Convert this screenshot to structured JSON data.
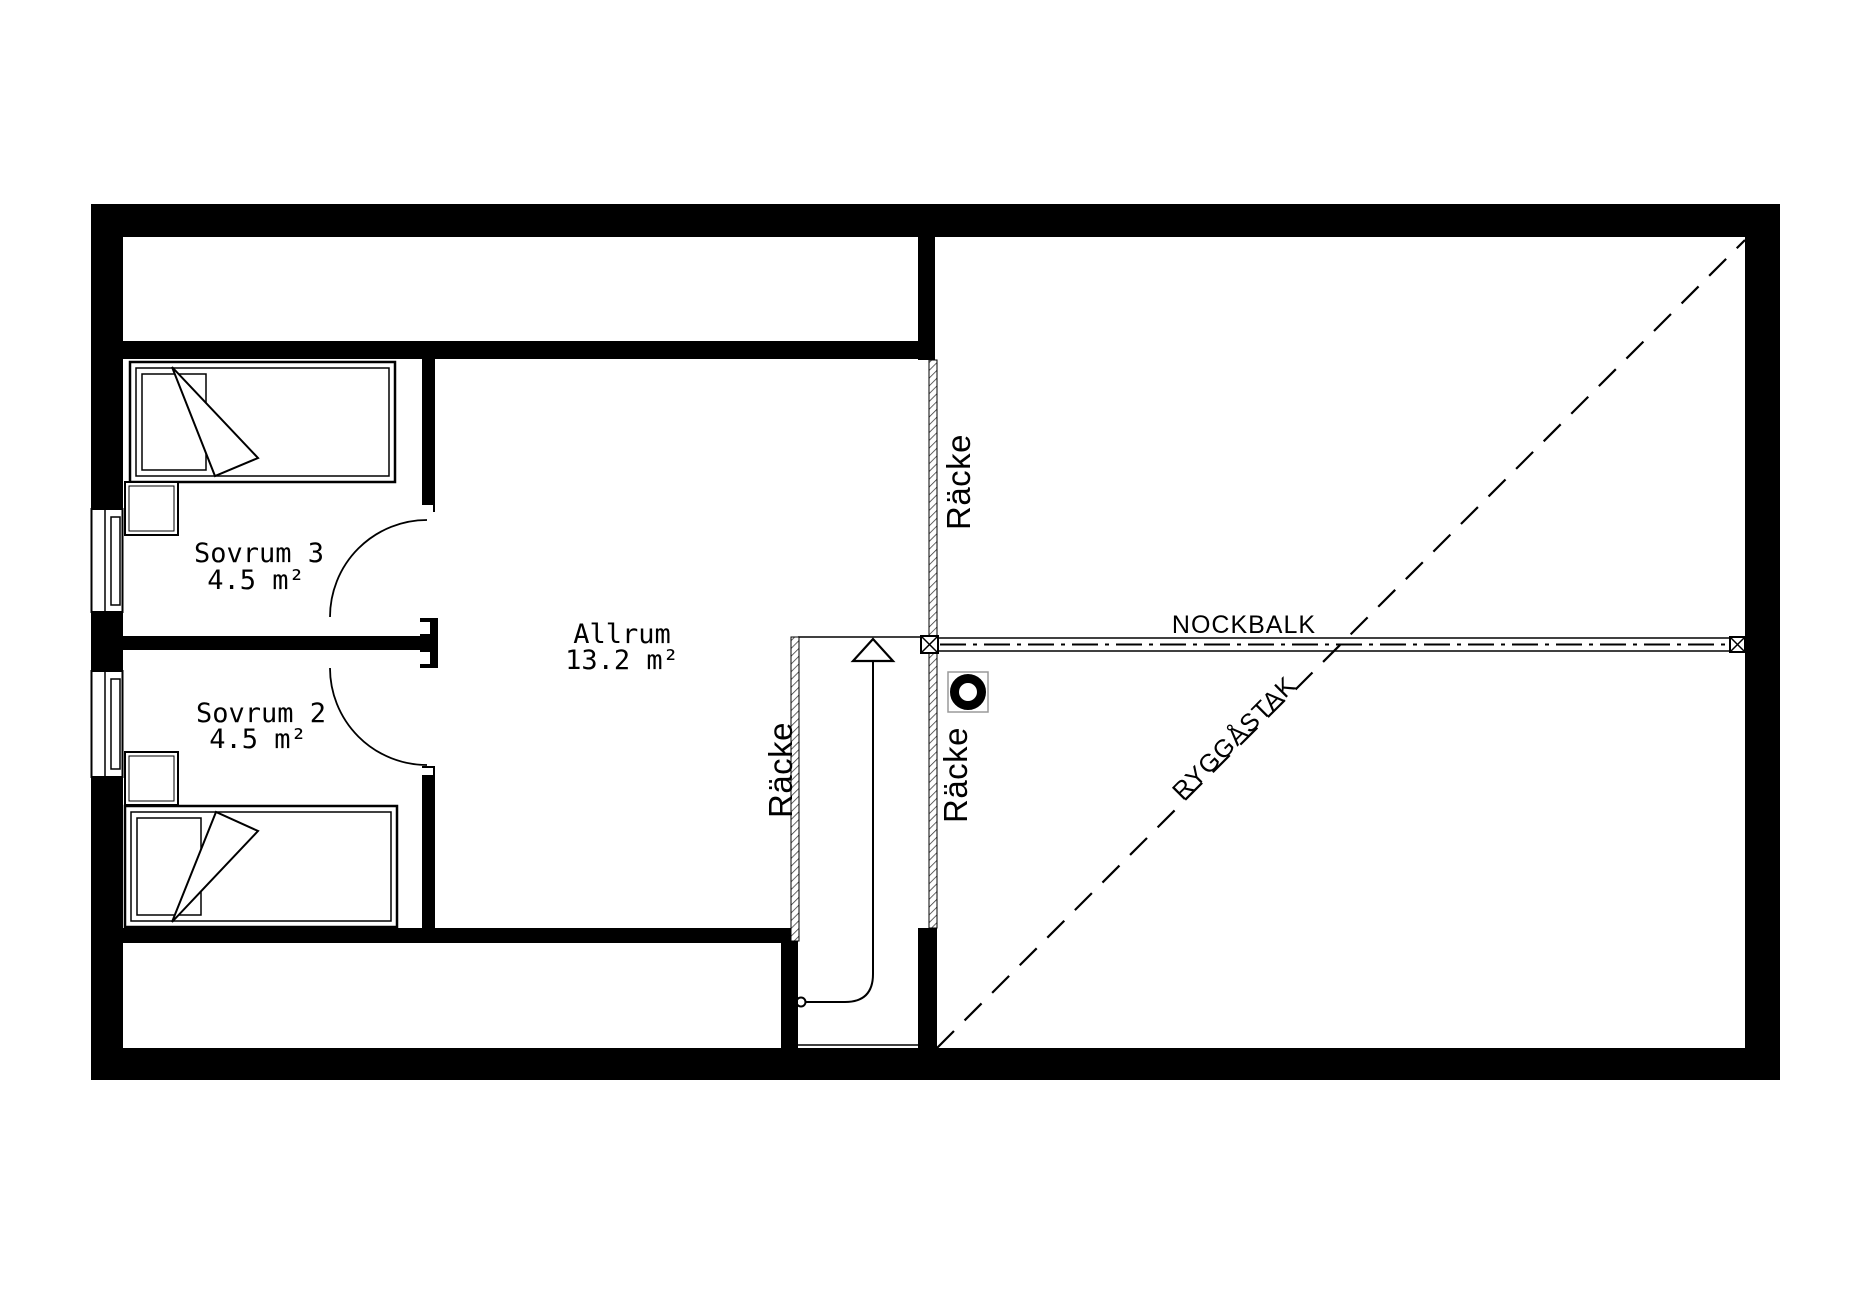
{
  "plan": {
    "rooms": [
      {
        "name": "Sovrum 3",
        "area": "4.5 m²"
      },
      {
        "name": "Sovrum 2",
        "area": "4.5 m²"
      },
      {
        "name": "Allrum",
        "area": "13.2 m²"
      }
    ],
    "labels": {
      "nockbalk": "NOCKBALK",
      "ryggastak": "RYGGÅSTAK",
      "racke": "Räcke"
    },
    "symbols": {
      "stairs_direction": "up-arrow",
      "beam_end": "crossed-box",
      "chimney": "ring"
    },
    "colors": {
      "wall": "#000000",
      "background": "#ffffff",
      "hatch": "#333333",
      "symbol_box": "#9a9a9a"
    }
  }
}
